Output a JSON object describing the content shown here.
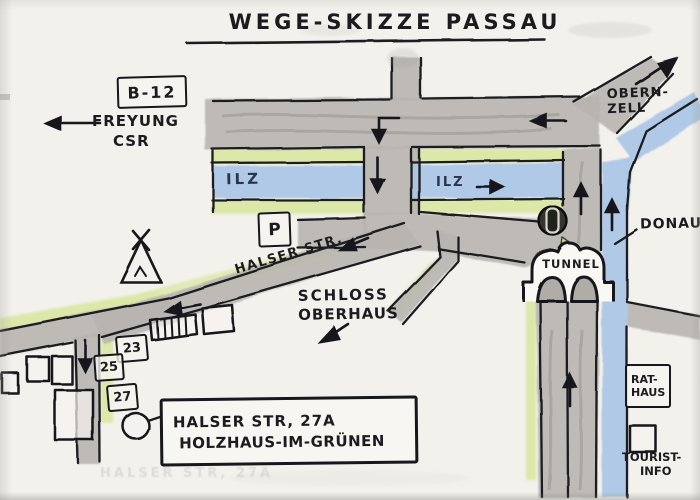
{
  "title": "WEGE-SKIZZE PASSAU",
  "labels": {
    "route_box": "B-12",
    "freyung": "FREYUNG",
    "csr": "CSR",
    "obernzell_line1": "OBERN-",
    "obernzell_line2": "ZELL",
    "ilz_left": "ILZ",
    "ilz_right": "ILZ",
    "donau": "DONAU",
    "tunnel": "TUNNEL",
    "parking": "P",
    "halser_str": "HALSER STR.",
    "schloss_line1": "SCHLOSS",
    "schloss_line2": "OBERHAUS",
    "rathaus_line1": "RAT-",
    "rathaus_line2": "HAUS",
    "tourist_line1": "TOURIST-",
    "tourist_line2": "INFO"
  },
  "houses": {
    "h23": "23",
    "h25": "25",
    "h27": "27"
  },
  "address_box": {
    "line1": "HALSER STR, 27A",
    "line2": "HOLZHAUS-IM-GRÜNEN"
  },
  "colors": {
    "ink": "#1c1c20",
    "road_gray": "#b7b4ae",
    "river_blue": "#a9c6e6",
    "green_edge": "#dce8a8",
    "paper": "#f3f1ec"
  }
}
